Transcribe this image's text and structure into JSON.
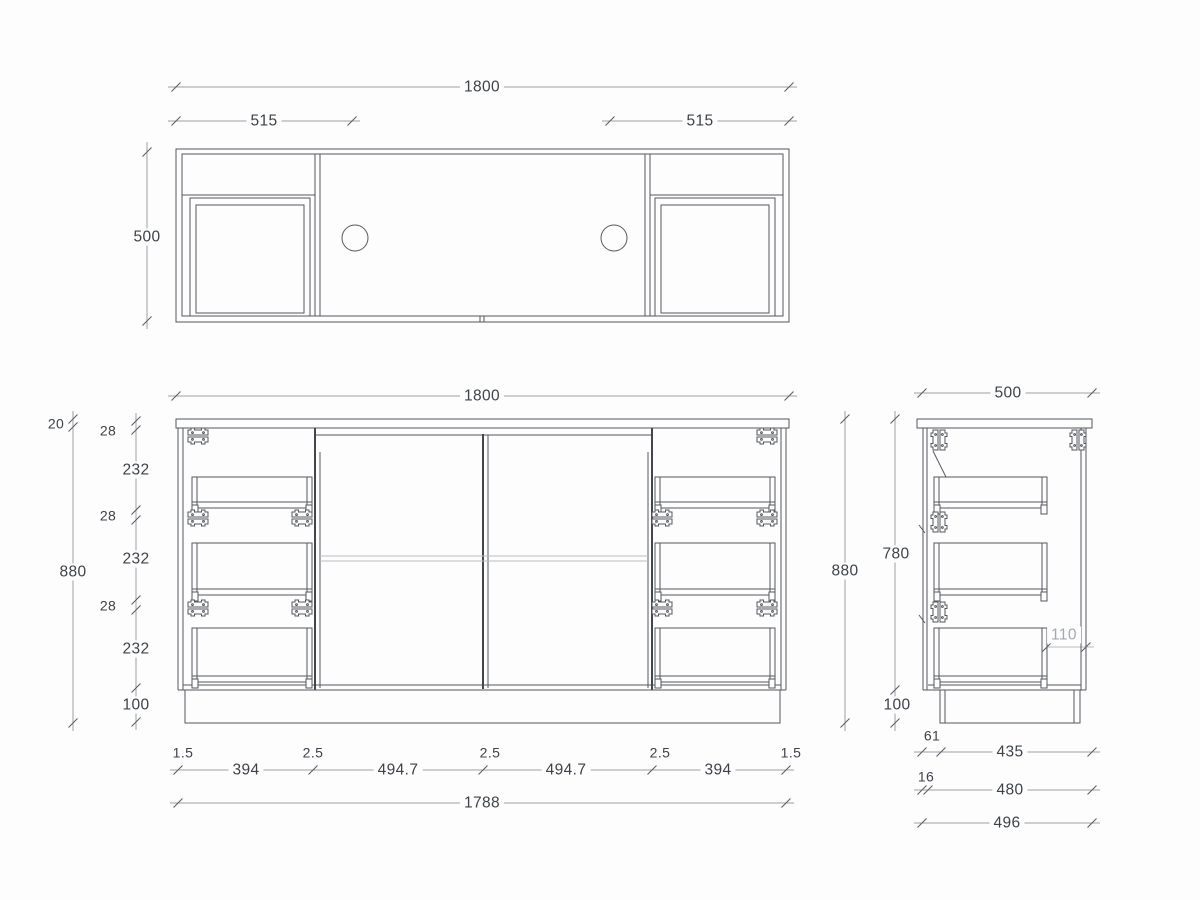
{
  "drawing": {
    "type": "vanity-cabinet-technical-drawing",
    "views": [
      "plan-view",
      "front-elevation",
      "side-elevation"
    ]
  },
  "colors": {
    "line": "#54585d",
    "thick_line": "#43474c",
    "dimension_line": "#9ba0a6",
    "text": "#3d4248",
    "muted_text": "#a4a9ae",
    "background": "#fdfdfe"
  },
  "dims": {
    "top": {
      "overall": "1800",
      "left": "515",
      "right": "515",
      "depth": "500"
    },
    "front": {
      "overall": "1800",
      "total_height": "880",
      "countertop": "20",
      "g1": "28",
      "d1": "232",
      "g2": "28",
      "d2": "232",
      "g3": "28",
      "d3": "232",
      "kick": "100",
      "e1": "1.5",
      "f1": "394",
      "s1": "2.5",
      "door1": "494.7",
      "s2": "2.5",
      "door2": "494.7",
      "s3": "2.5",
      "f2": "394",
      "e2": "1.5",
      "carcass": "1788"
    },
    "side": {
      "depth": "500",
      "total_height": "880",
      "body": "780",
      "clearance": "110",
      "kick": "100",
      "recess": "61",
      "kick_depth": "435",
      "panel": "16",
      "carcass": "480",
      "overall": "496"
    }
  }
}
